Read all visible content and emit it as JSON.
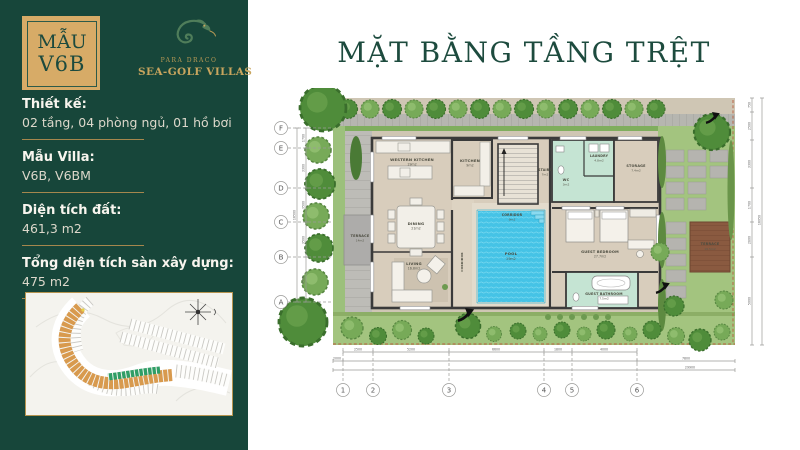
{
  "sidebar": {
    "badge": {
      "top": "MẪU",
      "model": "V6B"
    },
    "logo": {
      "brand": "PARA DRACO",
      "name": "SEA-GOLF VILLAS"
    },
    "specs": [
      {
        "label": "Thiết kế:",
        "value": "02 tầng, 04 phòng ngủ, 01 hồ bơi"
      },
      {
        "label": "Mẫu Villa:",
        "value": "V6B, V6BM"
      },
      {
        "label": "Diện tích đất:",
        "value": "461,3 m2"
      },
      {
        "label": "Tổng diện tích sàn xây dựng:",
        "value": "475 m2"
      }
    ]
  },
  "main": {
    "title": "MẶT BẰNG TẦNG TRỆT"
  },
  "floorplan": {
    "grid_rows": [
      "F",
      "E",
      "D",
      "C",
      "B",
      "A"
    ],
    "grid_cols": [
      "1",
      "2",
      "3",
      "4",
      "5",
      "6"
    ],
    "rooms": {
      "western_kitchen": {
        "name": "WESTERN KITCHEN",
        "area": "19m2"
      },
      "kitchen": {
        "name": "KITCHEN",
        "area": "9m2"
      },
      "stairs": {
        "name": "STAIRS",
        "area": "7m2"
      },
      "corridor_top": {
        "name": "CORRIDOR",
        "area": "9m2"
      },
      "corridor_left": {
        "name": "CORRIDOR",
        "area": ""
      },
      "dining": {
        "name": "DINING",
        "area": "21m2"
      },
      "living": {
        "name": "LIVING",
        "area": "16.8m2"
      },
      "terrace_left": {
        "name": "TERRACE",
        "area": "14m2"
      },
      "wc": {
        "name": "WC",
        "area": "3m2"
      },
      "laundry": {
        "name": "LAUNDRY",
        "area": "4.8m2"
      },
      "storage": {
        "name": "STORAGE",
        "area": "7.4m2"
      },
      "guest_bedroom": {
        "name": "GUEST BEDROOM",
        "area": "27.7m2"
      },
      "guest_bathroom": {
        "name": "GUEST BATHROOM",
        "area": "7.5m2"
      },
      "pool": {
        "name": "POOL",
        "area": "29m2"
      },
      "terrace_wood": {
        "name": "TERRACE",
        "area": "19.5m2"
      }
    },
    "dims_bottom": [
      "2000",
      "2500",
      "5200",
      "6600",
      "1800",
      "4000",
      "7800"
    ],
    "dims_bottom_total": "29900",
    "dims_left": [
      "1700",
      "3300",
      "3500",
      "3500",
      "4500"
    ],
    "dims_left_total": "16500",
    "dims_right": [
      "750",
      "2500",
      "3300",
      "1700",
      "2800",
      "5000"
    ],
    "dims_right_total": "16050"
  },
  "colors": {
    "sidebar_green": "#17463a",
    "gold": "#c8a55e",
    "badge_tan": "#d7ab67",
    "title_green": "#1d4b3e",
    "pool_blue": "#45c3e6",
    "mint_room": "#c5e4d3",
    "wood_brown": "#8a5a40",
    "grass_green": "#a3c47f",
    "lot_orange": "#d89a4e",
    "lot_green": "#2f9e66"
  }
}
